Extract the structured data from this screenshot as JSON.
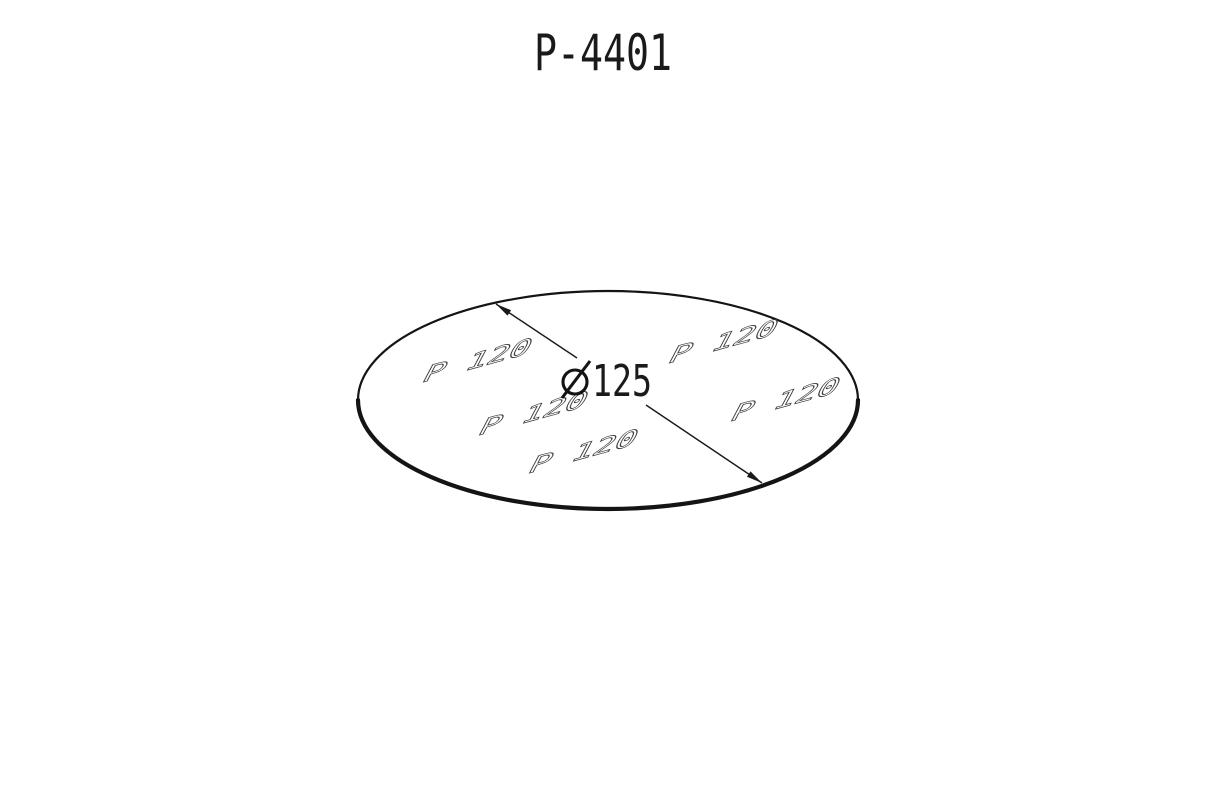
{
  "page": {
    "background": "#ffffff"
  },
  "drawing": {
    "title": "P-4401",
    "dimension": {
      "symbol": "⌀",
      "value": "125",
      "display": "⌀125"
    },
    "grit_labels": [
      "P 120",
      "P 120",
      "P 120",
      "P 120",
      "P 120"
    ],
    "colors": {
      "ink": "#1a1a1a",
      "grit_outline": "#3d3d3d",
      "grit_fill": "#ffffff",
      "background": "#ffffff"
    }
  }
}
